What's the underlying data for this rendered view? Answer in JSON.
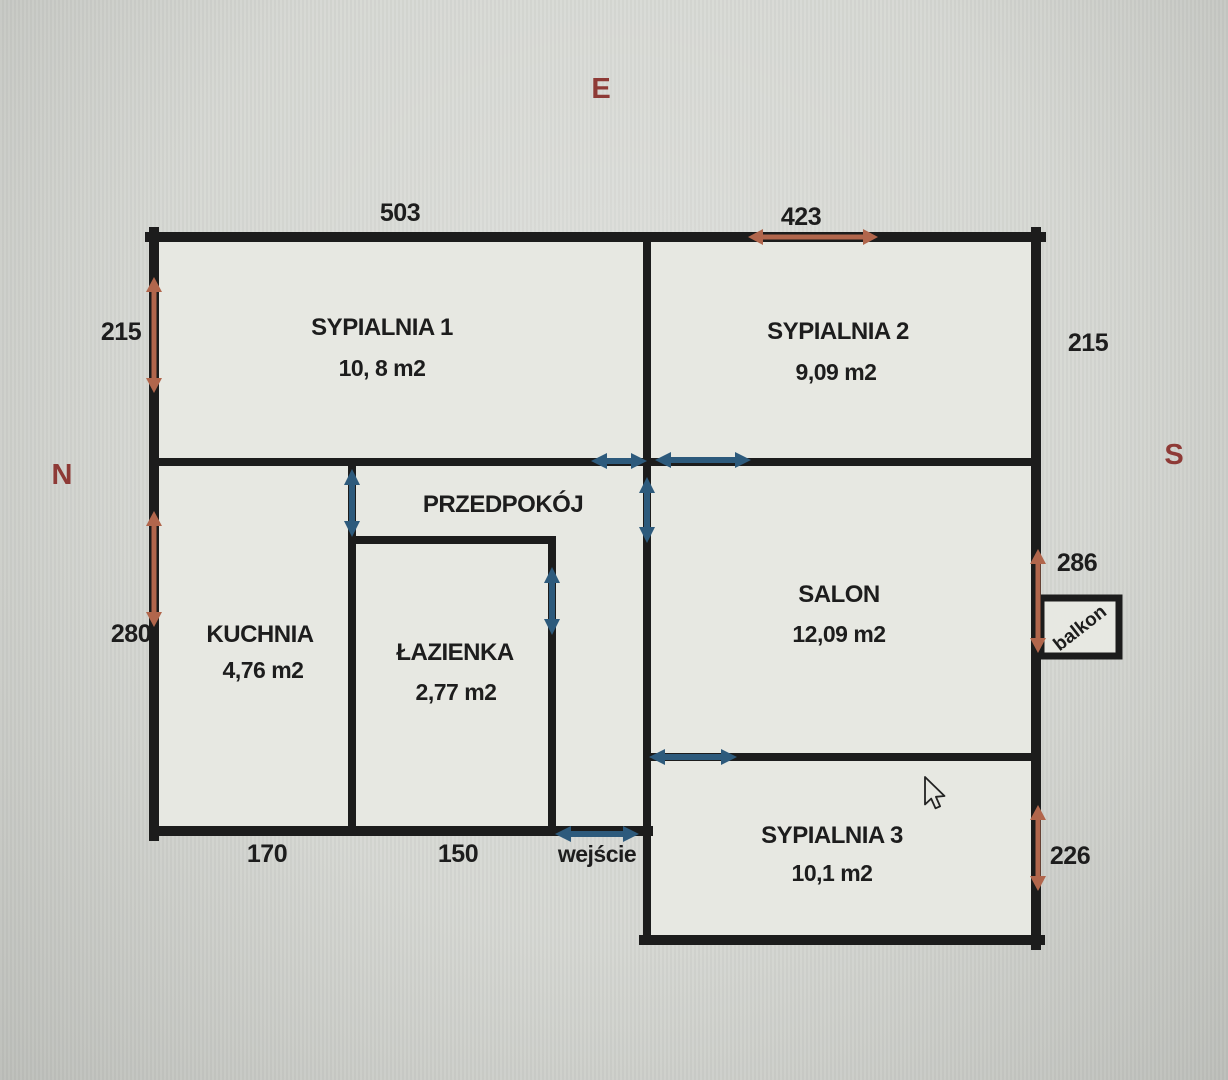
{
  "compass": {
    "east": "E",
    "north": "N",
    "south": "S"
  },
  "rooms": {
    "sypialnia1": {
      "name": "SYPIALNIA 1",
      "area": "10, 8 m2"
    },
    "sypialnia2": {
      "name": "SYPIALNIA 2",
      "area": "9,09 m2"
    },
    "przedpokoj": {
      "name": "PRZEDPOKÓJ",
      "area": ""
    },
    "kuchnia": {
      "name": "KUCHNIA",
      "area": "4,76 m2"
    },
    "lazienka": {
      "name": "ŁAZIENKA",
      "area": "2,77 m2"
    },
    "salon": {
      "name": "SALON",
      "area": "12,09 m2"
    },
    "sypialnia3": {
      "name": "SYPIALNIA 3",
      "area": "10,1 m2"
    },
    "balkon": {
      "name": "balkon"
    }
  },
  "dimensions": {
    "sypialnia1_width_top": "503",
    "sypialnia2_width_top": "423",
    "sypialnia1_height_left": "215",
    "sypialnia2_height_right": "215",
    "kuchnia_height_left": "280",
    "salon_height_right": "286",
    "sypialnia3_height_right": "226",
    "kuchnia_width_bottom": "170",
    "lazienka_width_bottom": "150"
  },
  "entrance": {
    "label": "wejście"
  },
  "colors": {
    "wall": "#1c1c1c",
    "dimension_arrow": "#b1664c",
    "door_arrow": "#2d5a7c",
    "compass_text": "#8e3a36",
    "label_text": "#1d1d1d",
    "background": "#d2d4cf",
    "floor": "#e7e8e2"
  }
}
